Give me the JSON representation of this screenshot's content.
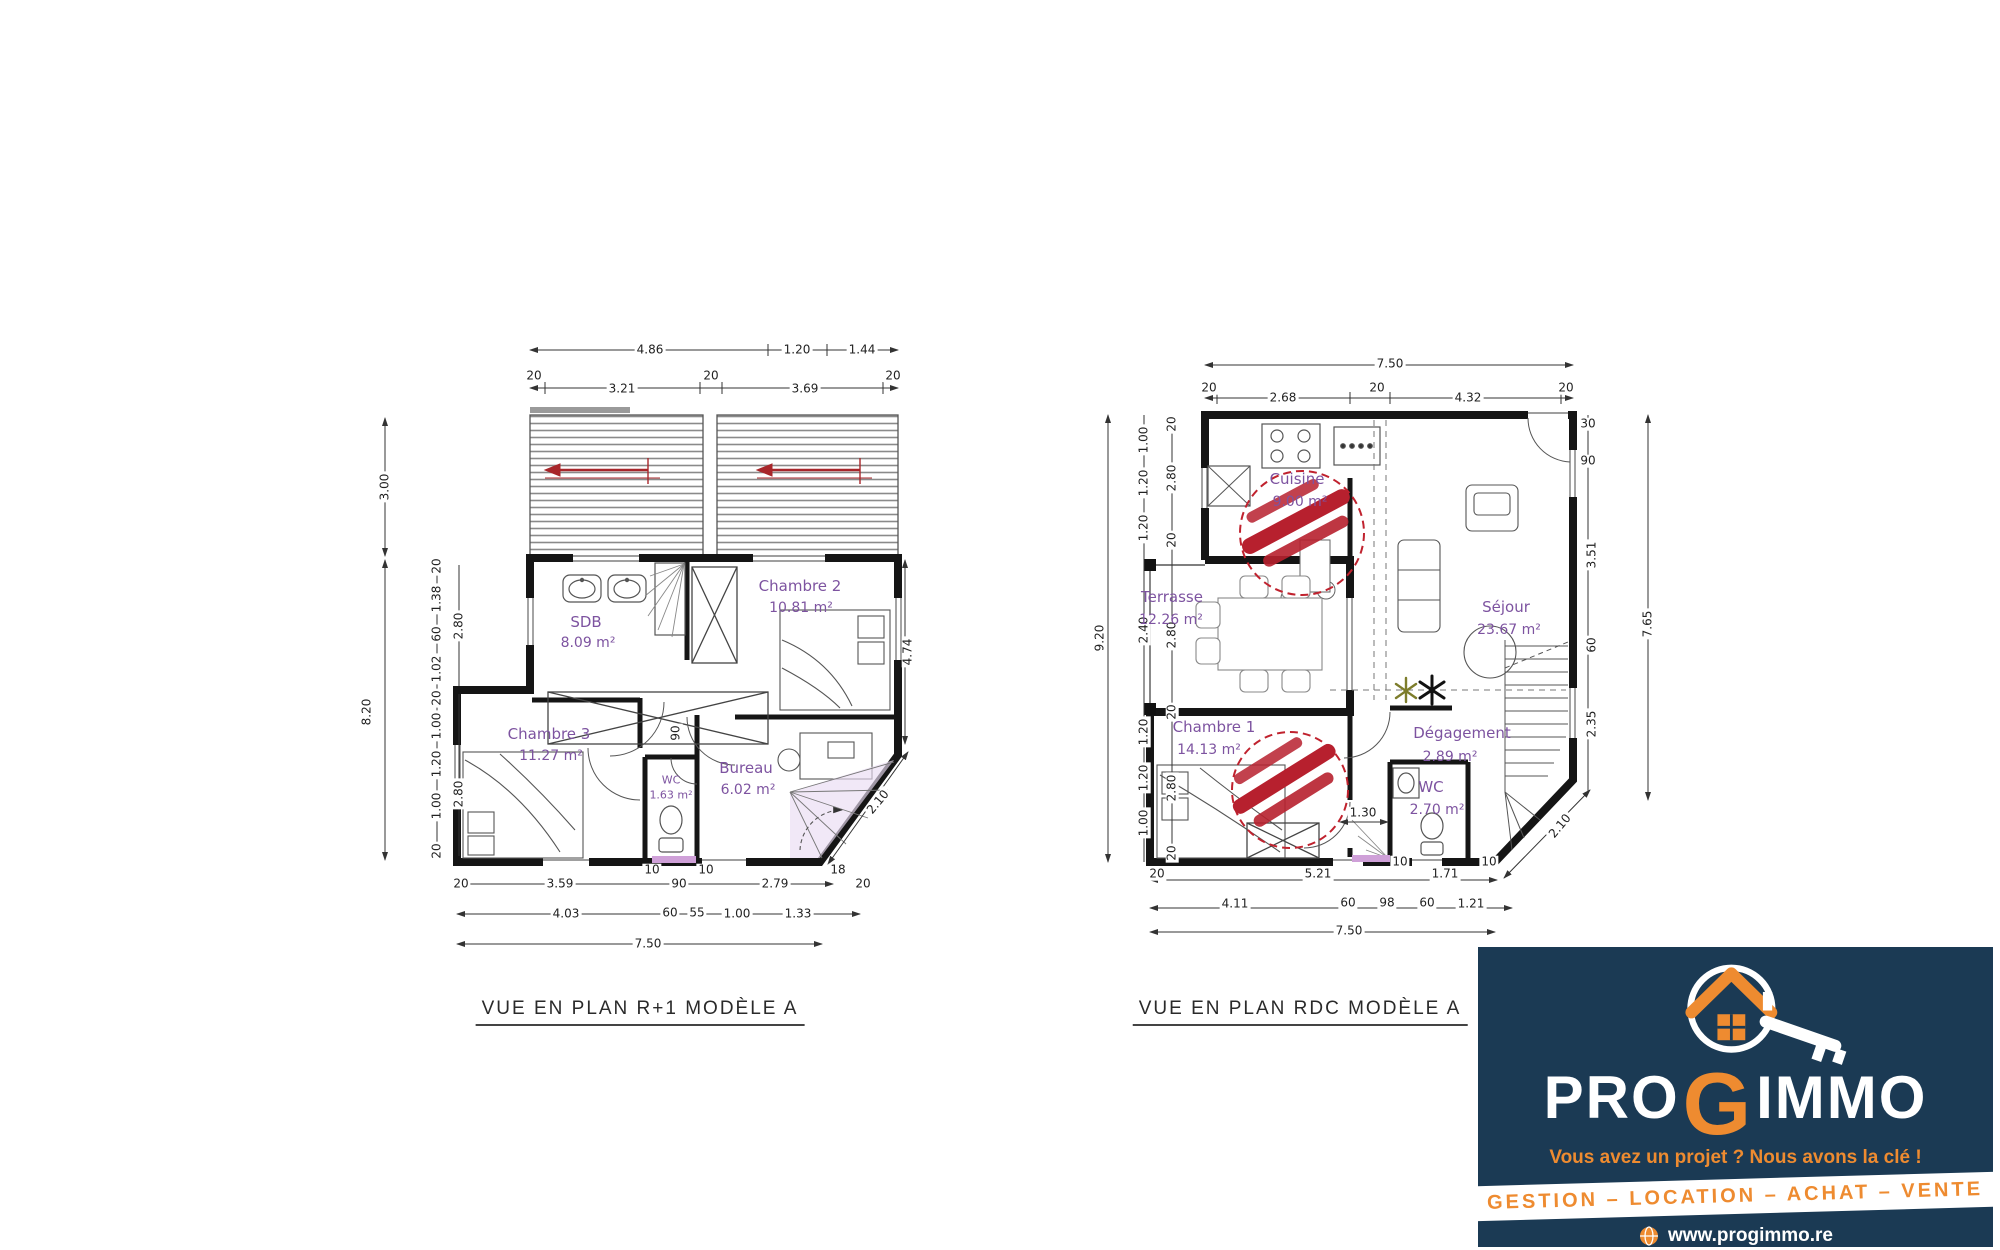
{
  "page": {
    "background": "#ffffff"
  },
  "left_plan": {
    "title": "VUE EN PLAN R+1 MODÈLE A",
    "rooms": {
      "sdb": {
        "name": "SDB",
        "area": "8.09 m²"
      },
      "chambre2": {
        "name": "Chambre 2",
        "area": "10.81 m²"
      },
      "chambre3": {
        "name": "Chambre 3",
        "area": "11.27 m²"
      },
      "wc": {
        "name": "WC",
        "area": "1.63 m²"
      },
      "bureau": {
        "name": "Bureau",
        "area": "6.02 m²"
      }
    },
    "dims": {
      "top_row1": [
        "4.86",
        "1.20",
        "1.44"
      ],
      "top_row2": [
        "20",
        "3.21",
        "20",
        "3.69",
        "20"
      ],
      "left_outer": [
        "3.00",
        "8.20"
      ],
      "left_mid": [
        "20",
        "1.38",
        "60",
        "1.02",
        "20",
        "1.00",
        "1.20",
        "1.00",
        "20"
      ],
      "left_inner": [
        "2.80",
        "2.80"
      ],
      "right_side": [
        "4.74"
      ],
      "diagonal": [
        "2.10"
      ],
      "bottom_row1": [
        "20",
        "3.59",
        "10",
        "90",
        "10",
        "2.79",
        "18",
        "20"
      ],
      "bottom_row2": [
        "4.03",
        "60",
        "55",
        "1.00",
        "1.33"
      ],
      "bottom_row3": [
        "7.50"
      ],
      "door": [
        "90"
      ]
    }
  },
  "right_plan": {
    "title": "VUE EN PLAN RDC MODÈLE A",
    "rooms": {
      "cuisine": {
        "name": "Cuisine",
        "area": "9.00 m²"
      },
      "terrasse": {
        "name": "Terrasse",
        "area": "12.26 m²"
      },
      "sejour": {
        "name": "Séjour",
        "area": "23.67 m²"
      },
      "chambre1": {
        "name": "Chambre 1",
        "area": "14.13 m²"
      },
      "degagement": {
        "name": "Dégagement",
        "area": "2.89 m²"
      },
      "wc": {
        "name": "WC",
        "area": "2.70 m²"
      }
    },
    "dims": {
      "top_row1": [
        "7.50"
      ],
      "top_row2": [
        "20",
        "2.68",
        "20",
        "4.32",
        "20"
      ],
      "left_outer": [
        "9.20"
      ],
      "left_mid": [
        "1.00",
        "1.20",
        "1.20",
        "2.40",
        "1.20",
        "1.20",
        "1.00"
      ],
      "left_inner": [
        "20",
        "2.80",
        "20",
        "2.80",
        "20",
        "2.80",
        "20"
      ],
      "right_inner": [
        "30",
        "90",
        "3.51",
        "60",
        "2.35"
      ],
      "right_outer": [
        "7.65"
      ],
      "diagonal": [
        "2.10"
      ],
      "bottom_row1": [
        "20",
        "5.21",
        "10",
        "1.71",
        "10"
      ],
      "bottom_row2": [
        "4.11",
        "60",
        "98",
        "60",
        "1.21"
      ],
      "bottom_row3": [
        "7.50"
      ],
      "door": [
        "1.30"
      ]
    }
  },
  "logo": {
    "brand_pro": "PRO",
    "brand_g": "G",
    "brand_immo": "IMMO",
    "tagline": "Vous avez un projet ? Nous avons la clé !",
    "banner": "GESTION – LOCATION – ACHAT – VENTE",
    "website": "www.progimmo.re",
    "colors": {
      "navy": "#1b3a54",
      "orange": "#ee8b30",
      "stamp_red": "#c0222e"
    }
  }
}
